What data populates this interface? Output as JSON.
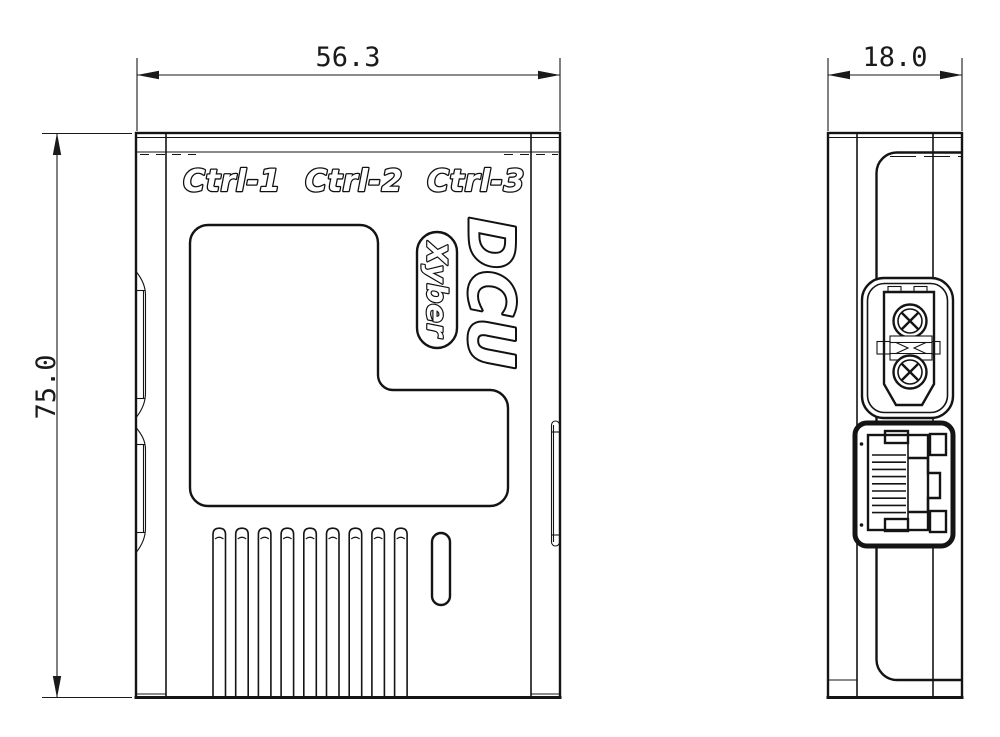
{
  "drawing": {
    "front_view": {
      "port_labels": [
        "Ctrl-1",
        "Ctrl-2",
        "Ctrl-3"
      ],
      "product_name": "DCU",
      "brand_badge": "Xyber",
      "width_dim": "56.3",
      "height_dim": "75.0"
    },
    "side_view": {
      "depth_dim": "18.0"
    },
    "colors": {
      "line": "#141414",
      "background": "#ffffff",
      "label_fill": "#ffffff"
    }
  }
}
